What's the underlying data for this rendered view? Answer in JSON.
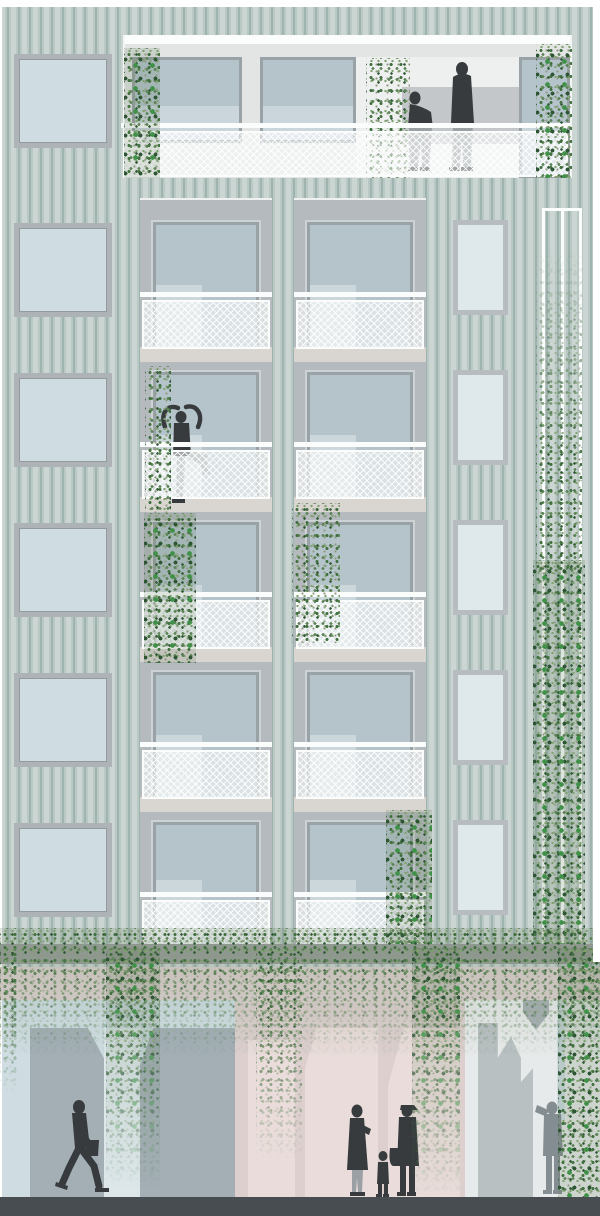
{
  "scene": {
    "type": "architectural-elevation-drawing",
    "title": "Residential facade elevation with corrugated cladding, balconies and climbing plants",
    "structure": {
      "balcony_floors": 5,
      "balcony_bays": 2,
      "roof_terrace": 1,
      "left_window_column_windows": 6,
      "right_window_column_windows": 5,
      "trellis_columns": 1,
      "ground_level_storefronts": 2
    },
    "labels": {
      "canvas": "building elevation drawing",
      "terrace": "recessed roof terrace with couple",
      "bay_left": "left balcony bay column",
      "bay_right": "right balcony bay column",
      "trellis": "planting trellis with climbing vine",
      "planter": "continuous planter band with trailing plants",
      "ground": "street-level storefronts",
      "street": "sidewalk"
    },
    "figures": [
      {
        "name": "couple-on-terrace",
        "count": 2
      },
      {
        "name": "dancer-on-balcony",
        "count": 1
      },
      {
        "name": "pedestrian-walking",
        "count": 1
      },
      {
        "name": "family-group-with-child",
        "count": 3
      },
      {
        "name": "person-watching",
        "count": 1
      }
    ],
    "plants": {
      "terrace_vines": 3,
      "balcony_vines": 4,
      "trellis_vine": 1,
      "planter_fringe": 1,
      "ground_vine_columns": 5
    },
    "palette": {
      "paper": "#ffffff",
      "claddingLight": "#cbd6d2",
      "claddingMid": "#b9c8c4",
      "claddingDark": "#9fb3af",
      "bayPanel": "#b4babd",
      "slab": "#d9d6d2",
      "frameGrey": "#99a2a6",
      "glassBlue": "#b5c4cb",
      "glassPale": "#d0dbde",
      "sqGlass": "#cfdde3",
      "sqFrame": "#adb3b7",
      "narGlass": "#dfe8ea",
      "narFrame": "#b6bcbf",
      "terraceWall": "#e3e5e4",
      "terraceWhite": "#eef0ef",
      "terraceBand": "#c3c7c9",
      "railWhite": "#fbfcfc",
      "meshTint": "rgba(249,251,251,0.55)",
      "planter": "#9aa09b",
      "foliageD": "#41703f",
      "foliageM": "#5c8356",
      "foliageDk": "#2e5634",
      "foliageL": "#7fa06f",
      "foliageG": "#8d9a80",
      "foliageBright": "#3f9147",
      "pinkBand": "#ddd1d0",
      "pinkWall": "#dccfce",
      "pinkLight": "#e9dcda",
      "storeGlassL": "#cfdde2",
      "storeGlassR": "#e7eaea",
      "storeShape": "#a3afb5",
      "storeShapeR": "#b9c0c2",
      "street": "#474d50",
      "figDark": "#373b3e",
      "figMid": "#9aa0a3",
      "figGrey": "#848d91"
    }
  }
}
